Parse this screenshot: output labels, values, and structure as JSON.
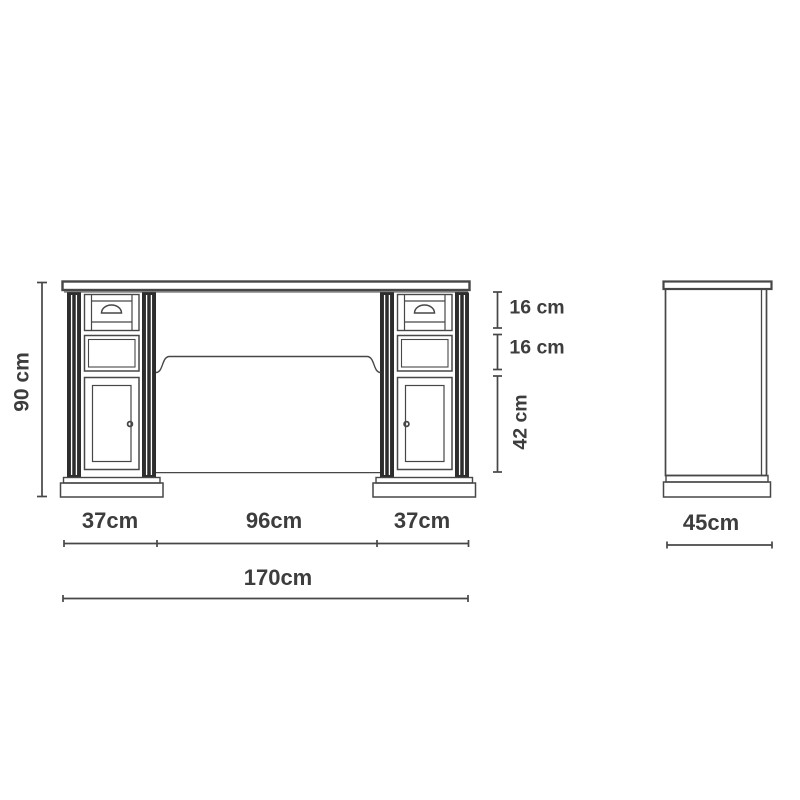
{
  "diagram_type": "furniture dimension drawing (desk, front and side elevation)",
  "labels": {
    "height": "90 cm",
    "top_drawer_height": "16 cm",
    "middle_drawer_height": "16 cm",
    "door_height": "42 cm",
    "left_pedestal_width": "37cm",
    "knee_space_width": "96cm",
    "right_pedestal_width": "37cm",
    "total_width": "170cm",
    "depth": "45cm"
  },
  "colors": {
    "background": "#ffffff",
    "line": "#474747",
    "column_fill": "#2d2d2d",
    "text": "#3d3d3d"
  }
}
